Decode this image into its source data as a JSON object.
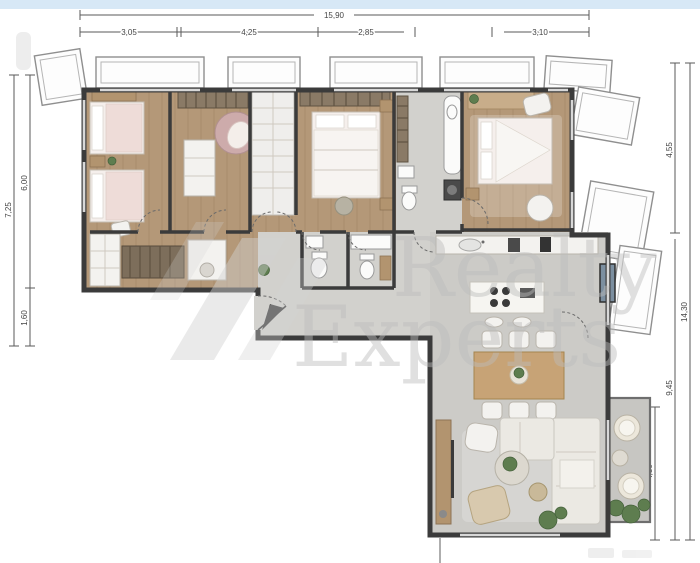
{
  "top_bar": {
    "color": "#d7e8f6"
  },
  "watermark": {
    "line1": "Realty",
    "line2": "Experts",
    "color": "#bcbcbc"
  },
  "dimensions": {
    "top": {
      "total": "15,90",
      "segments": [
        {
          "label": "3,05"
        },
        {
          "label": "4,25"
        },
        {
          "label": "2,85"
        },
        {
          "label": "3,10"
        }
      ]
    },
    "left": {
      "total": "7,25",
      "segments": [
        {
          "label": "6,00"
        },
        {
          "label": "1,60"
        }
      ]
    },
    "right": {
      "total": "14,30",
      "segments": [
        {
          "label": "4,55"
        },
        {
          "label": "9,45"
        },
        {
          "label": "4,30"
        }
      ]
    }
  },
  "rooms": [
    {
      "name": "twin-bedroom"
    },
    {
      "name": "bedroom-2"
    },
    {
      "name": "wardrobe-closet"
    },
    {
      "name": "bedroom-3"
    },
    {
      "name": "bathroom"
    },
    {
      "name": "master-bedroom"
    },
    {
      "name": "corridor"
    },
    {
      "name": "wc-1"
    },
    {
      "name": "wc-2"
    },
    {
      "name": "entry-hall"
    },
    {
      "name": "kitchen"
    },
    {
      "name": "dining-area"
    },
    {
      "name": "living-room"
    },
    {
      "name": "balcony"
    }
  ],
  "colors": {
    "wood_floor": "#b49878",
    "corridor_wood": "#bda287",
    "tile_floor": "#d2d1cd",
    "living_floor": "#cccbc7",
    "balcony_floor": "#c7c6c2",
    "wall": "#3b3b3b",
    "bed_linen": "#f5efec",
    "blanket_pink": "#eedcd8",
    "accent_chair_pink": "#cdabab",
    "dining_wood": "#c7a376",
    "sofa_white": "#ebe9e3",
    "armchair_beige": "#d8c9ae",
    "plant_green": "#5e7d4f",
    "window_panel_blue": "#7c8fa0",
    "watermark_grey": "#d2d2d2"
  }
}
